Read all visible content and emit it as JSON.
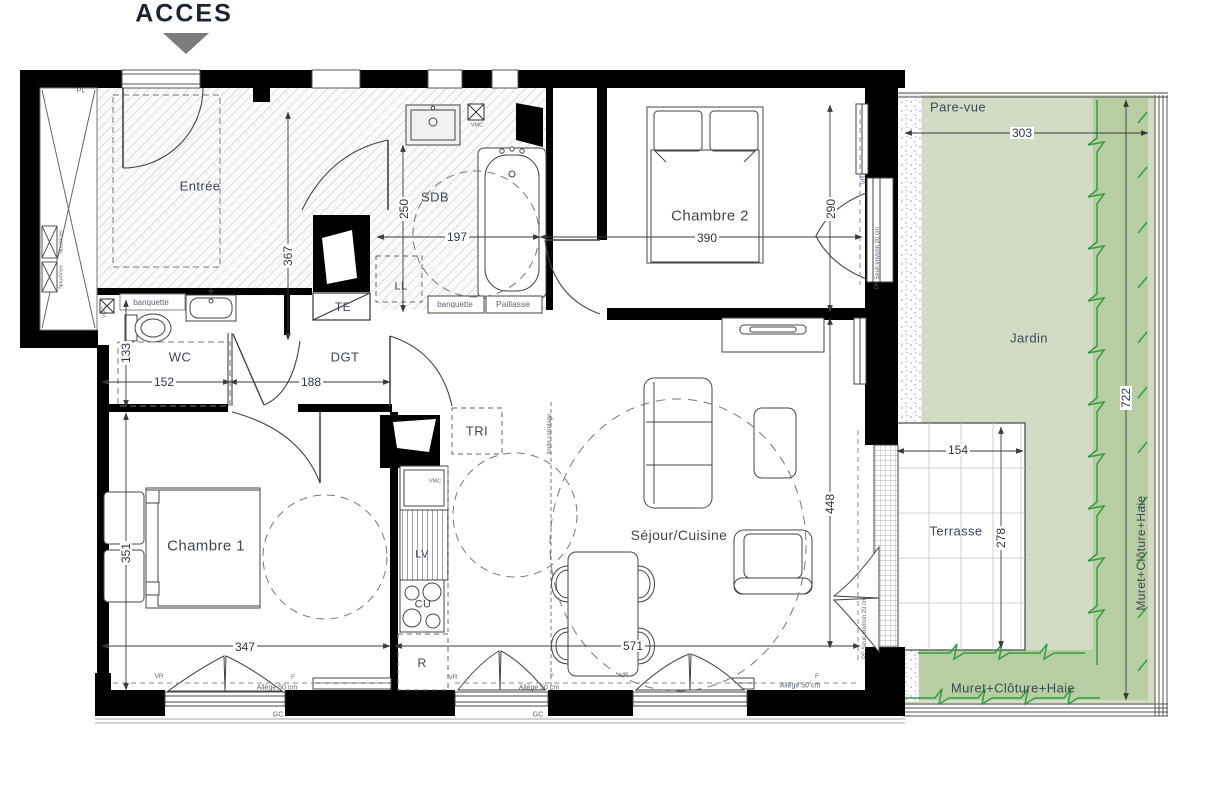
{
  "header": {
    "acces_label": "ACCES"
  },
  "rooms": {
    "entree": "Entrée",
    "sdb": "SDB",
    "chambre2": "Chambre 2",
    "wc": "WC",
    "dgt": "DGT",
    "chambre1": "Chambre 1",
    "sejour": "Séjour/Cuisine",
    "terrasse": "Terrasse",
    "jardin": "Jardin"
  },
  "dims": {
    "sdb_w": "197",
    "sdb_h": "250",
    "entree_h": "367",
    "chambre2_w": "390",
    "chambre2_h": "290",
    "wc_w": "152",
    "wc_h": "133",
    "dgt_w": "188",
    "chambre1_w": "347",
    "chambre1_h": "351",
    "sejour_w": "571",
    "sejour_h": "448",
    "terrasse_w": "154",
    "terrasse_h": "278",
    "jardin_w": "303",
    "jardin_h": "722"
  },
  "equipment": {
    "pl": "PL",
    "te": "TE",
    "ll": "LL",
    "lv": "LV",
    "cu": "CU",
    "refrigerateur": "R",
    "tri": "TRI",
    "vmc": "VMC",
    "nourrices": "Nourrices",
    "banquette": "banquette",
    "paillasse": "Paillasse"
  },
  "annotations": {
    "pare_vue": "Pare-vue",
    "muret": "Muret+Clôture+Haie",
    "limite_carrelage": "limite carrelage",
    "seuil": "PF Seuil environ 20 cm",
    "allege": "Allège 50 cm",
    "vr": "VR",
    "f": "F",
    "gc": "GC"
  },
  "colors": {
    "garden_light": "#d2dcc5",
    "garden_dark": "#b9cda3",
    "hedge_green": "#2f9e3f",
    "wall_black": "#000000"
  }
}
